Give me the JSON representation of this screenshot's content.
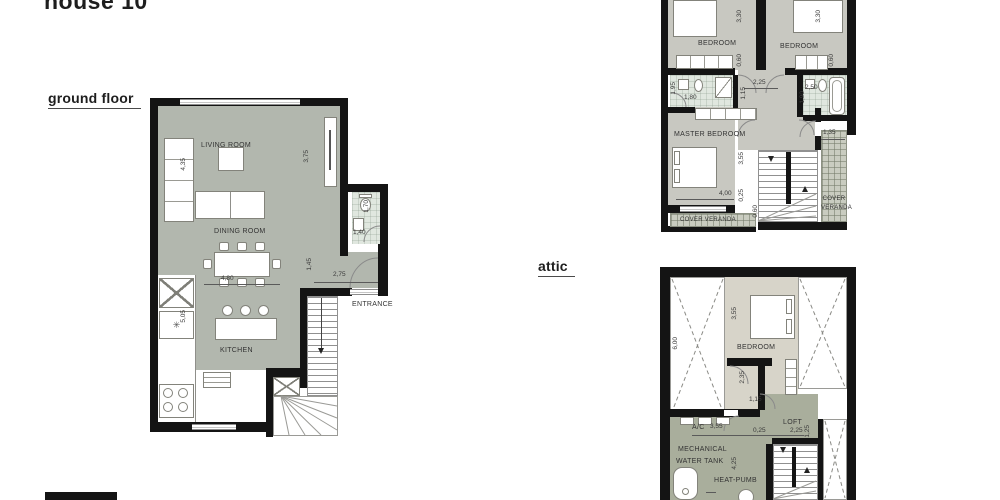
{
  "title": "house 10",
  "floor_labels": {
    "ground": "ground floor",
    "attic": "attic"
  },
  "colors": {
    "wall": "#141414",
    "ground_floor_finish": "#b2b7ae",
    "first_floor_finish": "#c8c8c1",
    "bathroom_finish": "#e0e7df",
    "attic_bedroom_finish": "#d7d4c9",
    "mechanical_finish": "#a9ae9c",
    "veranda_tile": "#c9ccc0"
  },
  "symbols": {
    "kitchen_star": "✳"
  },
  "ground_floor": {
    "living_room": "LIVING ROOM",
    "dining_room": "DINING ROOM",
    "kitchen": "KITCHEN",
    "entrance": "ENTRANCE",
    "dims": {
      "living_left": "4,35",
      "living_right": "3,75",
      "wc_height": "1,70",
      "wc_width": "1,40",
      "hall_height": "1,45",
      "hall_width": "2,75",
      "dining_width": "4,80",
      "kitchen_height": "5,05"
    }
  },
  "first_floor": {
    "bedroom_left": "BEDROOM",
    "bedroom_right": "BEDROOM",
    "master_bedroom": "MASTER BEDROOM",
    "cover_veranda_bottom": "COVER VERANDA",
    "cover_veranda_right_line1": "COVER",
    "cover_veranda_right_line2": "VERANDA",
    "dims": {
      "bedroom_left_depth": "3,30",
      "bedroom_right_depth": "3,30",
      "wardrobe_left_depth": "0,60",
      "wardrobe_right_depth": "0,60",
      "bath_left_width": "1,80",
      "bath_left_depth": "1,95",
      "bath_right_width": "2,50",
      "bath_right_depth": "1,90",
      "hall_width": "2,25",
      "hall_depth": "1,15",
      "master_depth": "3,55",
      "master_width": "4,00",
      "master_offset": "0,25",
      "veranda_bottom_depth": "0,60",
      "veranda_right_width": "1,35"
    }
  },
  "attic": {
    "bedroom": "BEDROOM",
    "loft": "LOFT",
    "mechanical_line1": "MECHANICAL",
    "mechanical_line2": "WATER TANK",
    "ac": "A/C",
    "heat_pump": "HEAT-PUMB",
    "dims": {
      "roof_left_depth": "6,00",
      "bedroom_depth": "3,55",
      "vestibule_depth": "2,35",
      "door_width": "1,15",
      "mech_width": "3,55",
      "loft_offset": "0,25",
      "loft_width": "2,25",
      "loft_depth": "1,25",
      "mech_depth": "4,25"
    }
  }
}
